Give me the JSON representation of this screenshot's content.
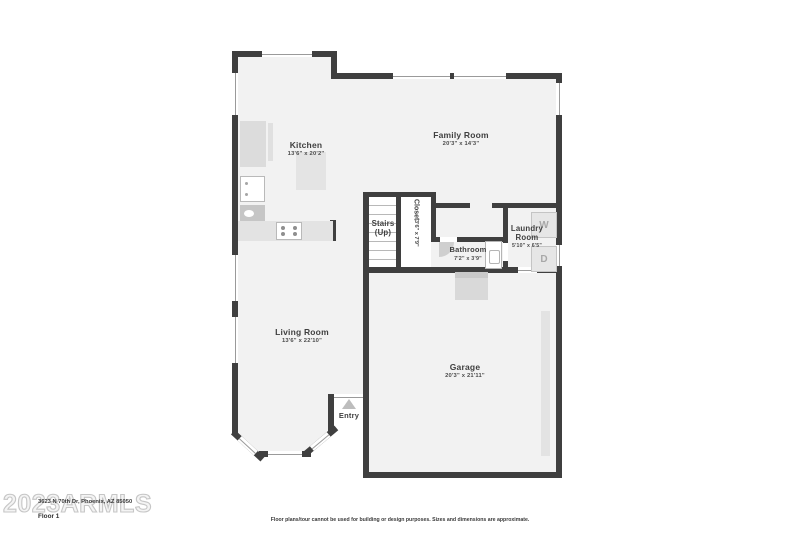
{
  "floorplan": {
    "rooms": {
      "kitchen": {
        "name": "Kitchen",
        "dims": "13'6\" x 20'2\""
      },
      "family_room": {
        "name": "Family Room",
        "dims": "20'3\" x 14'3\""
      },
      "living_room": {
        "name": "Living Room",
        "dims": "13'6\" x 22'10\""
      },
      "garage": {
        "name": "Garage",
        "dims": "20'3\" x 21'11\""
      },
      "bathroom": {
        "name": "Bathroom",
        "dims": "7'2\" x 3'9\""
      },
      "laundry": {
        "name_line1": "Laundry",
        "name_line2": "Room",
        "dims": "5'10\" x 6'5\""
      },
      "closet": {
        "name": "Closet",
        "dims": "3'6\" x 7'9\""
      },
      "stairs": {
        "name_line1": "Stairs",
        "name_line2": "(Up)"
      },
      "entry": {
        "name": "Entry"
      }
    },
    "appliances": {
      "washer_label": "W",
      "dryer_label": "D"
    }
  },
  "footer": {
    "address": "3623 N 70th Dr, Phoenix, AZ 85050",
    "floor_label": "Floor 1",
    "disclaimer": "Floor plans/tour cannot be used for building or design purposes. Sizes and dimensions are approximate.",
    "watermark": "2023ARMLS"
  },
  "colors": {
    "wall": "#3f3f3f",
    "room_fill": "#f2f2f2",
    "fixture_fill": "#dcdcdc",
    "label_text": "#3f3f3f",
    "watermark_outline": "#c6c6c6"
  }
}
